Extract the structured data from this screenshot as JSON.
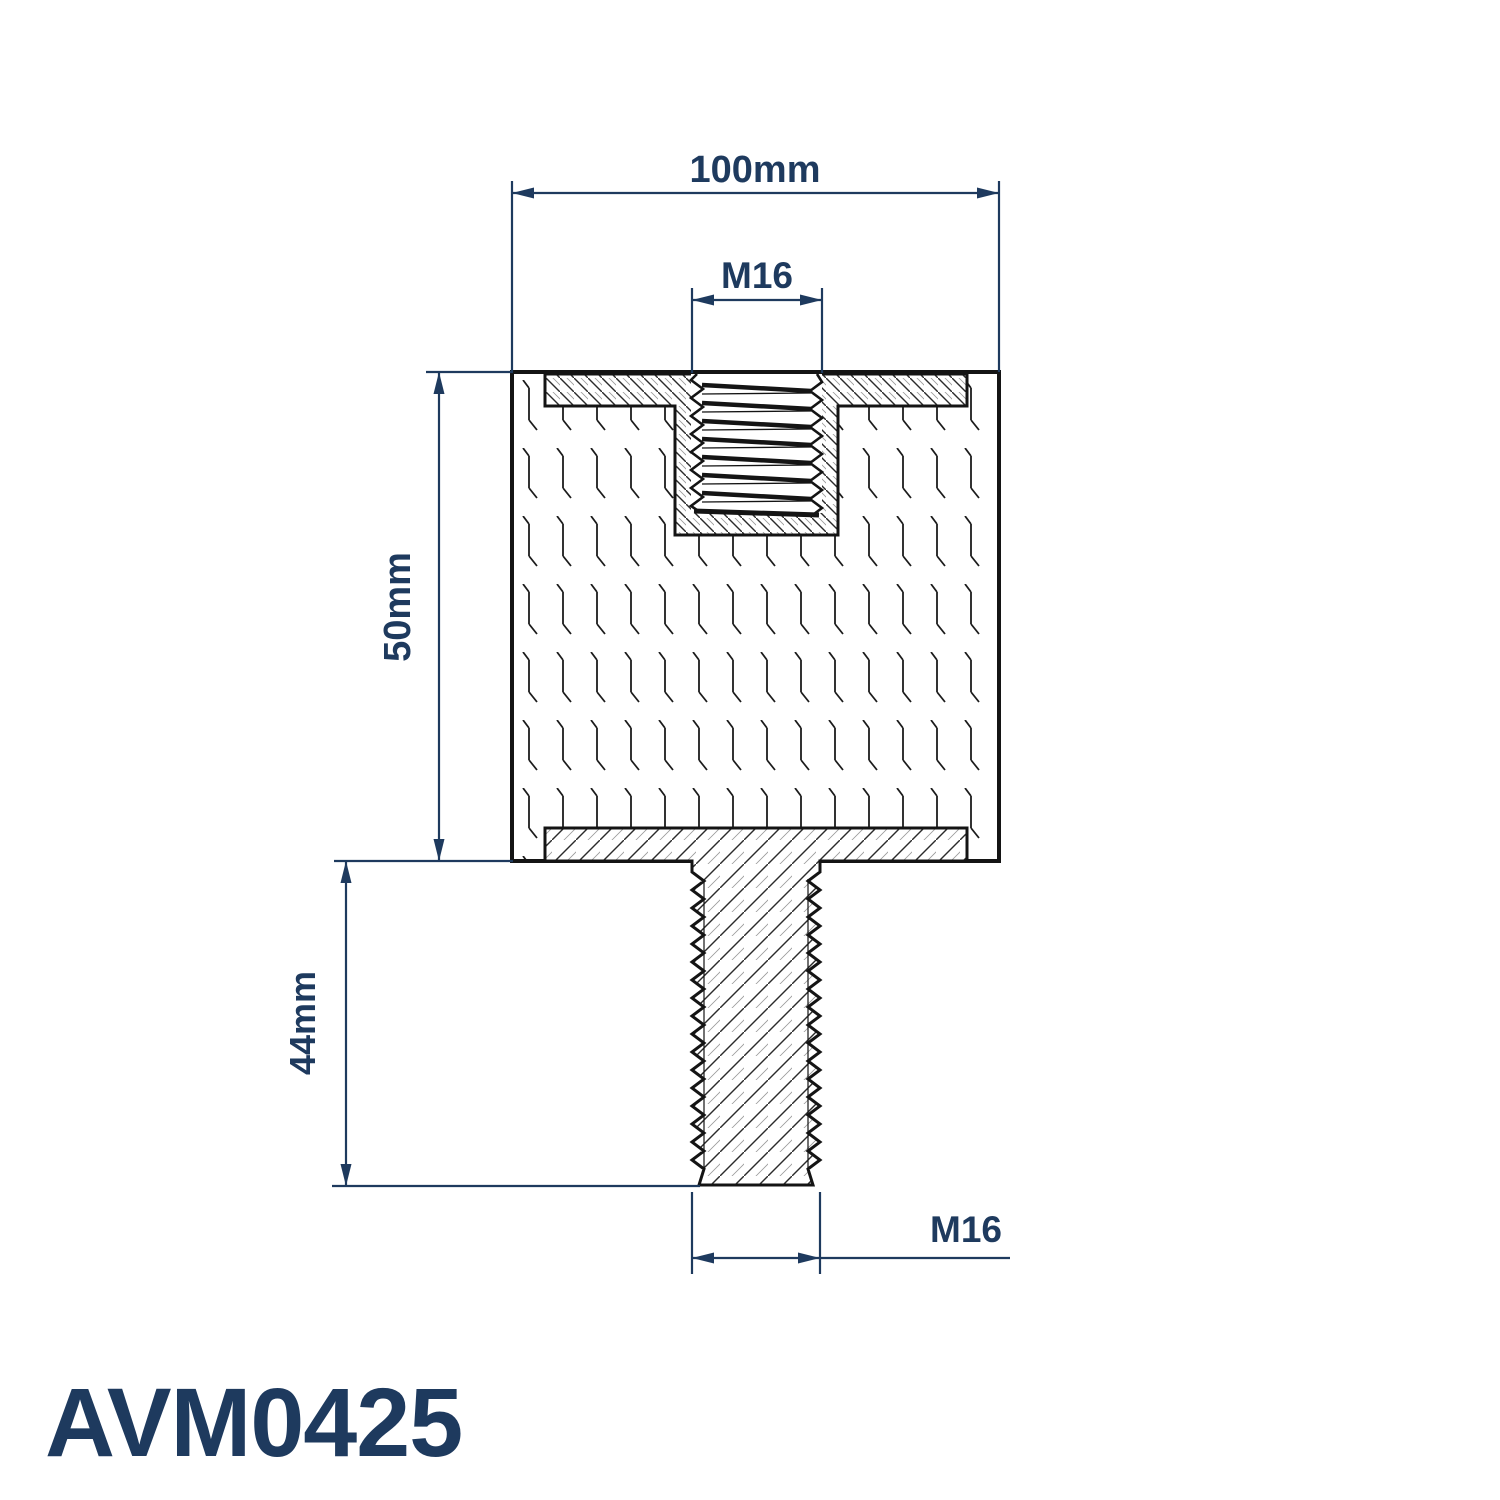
{
  "part": {
    "number": "AVM0425",
    "description": "Cylindrical anti-vibration mount, section view, female thread top / male stud bottom"
  },
  "dimensions": {
    "overall_width": "100mm",
    "top_thread": "M16",
    "body_height": "50mm",
    "stud_length": "44mm",
    "bottom_thread": "M16"
  },
  "colors": {
    "dimension_navy": "#1e3a5e",
    "drawing_line": "#141414",
    "background": "#ffffff"
  }
}
